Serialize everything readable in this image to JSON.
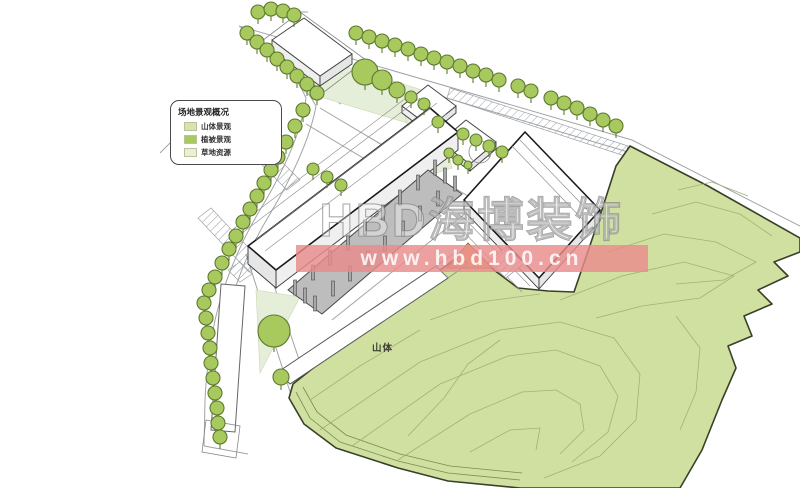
{
  "legend": {
    "title": "场地景观概况",
    "items": [
      {
        "label": "山体景观",
        "color": "#d8e4ae"
      },
      {
        "label": "植被景观",
        "color": "#a8c95e"
      },
      {
        "label": "草地资源",
        "color": "#e9efd9"
      }
    ]
  },
  "map_labels": {
    "mountain": "山体"
  },
  "watermark": {
    "brand": "HBD海博装饰",
    "url": "www.hbd100.cn"
  },
  "colors": {
    "background": "#ffffff",
    "mountain_fill": "#cfe0a0",
    "mountain_outline": "#384028",
    "contour_line": "#a3b178",
    "tree_fill": "#a8c95e",
    "tree_outline": "#5d7a30",
    "lawn_fill": "#e5eed8",
    "platform_fill": "#bdbdbd",
    "pillar_fill": "#a8a8a8",
    "building_fill": "#ffffff",
    "building_outline_bold": "#1a1a1a",
    "building_outline_light": "#888888",
    "road_line": "#a0a4a8",
    "slope_fill": "#e0a96b",
    "banner_fill": "#e98b8b",
    "banner_text": "#ffffff"
  },
  "diagram": {
    "trees": [
      [
        258,
        12,
        7
      ],
      [
        271,
        9,
        7
      ],
      [
        283,
        11,
        7
      ],
      [
        294,
        15,
        7
      ],
      [
        247,
        33,
        7
      ],
      [
        257,
        42,
        7
      ],
      [
        267,
        50,
        7
      ],
      [
        277,
        59,
        7
      ],
      [
        287,
        67,
        7
      ],
      [
        297,
        76,
        7
      ],
      [
        307,
        84,
        7
      ],
      [
        317,
        93,
        7
      ],
      [
        303,
        110,
        7
      ],
      [
        295,
        126,
        7
      ],
      [
        286,
        142,
        7
      ],
      [
        278,
        157,
        7
      ],
      [
        271,
        170,
        7
      ],
      [
        264,
        183,
        7
      ],
      [
        257,
        196,
        7
      ],
      [
        250,
        209,
        7
      ],
      [
        243,
        222,
        7
      ],
      [
        236,
        236,
        7
      ],
      [
        229,
        249,
        7
      ],
      [
        222,
        263,
        7
      ],
      [
        215,
        277,
        7
      ],
      [
        209,
        290,
        7
      ],
      [
        204,
        303,
        7
      ],
      [
        206,
        318,
        7
      ],
      [
        208,
        333,
        7
      ],
      [
        210,
        348,
        7
      ],
      [
        211,
        363,
        7
      ],
      [
        213,
        378,
        7
      ],
      [
        215,
        393,
        7
      ],
      [
        217,
        408,
        7
      ],
      [
        218,
        423,
        7
      ],
      [
        220,
        437,
        7
      ],
      [
        356,
        33,
        7
      ],
      [
        369,
        37,
        7
      ],
      [
        382,
        41,
        7
      ],
      [
        395,
        45,
        7
      ],
      [
        408,
        49,
        7
      ],
      [
        421,
        54,
        7
      ],
      [
        434,
        58,
        7
      ],
      [
        447,
        62,
        7
      ],
      [
        460,
        66,
        7
      ],
      [
        473,
        71,
        7
      ],
      [
        486,
        75,
        7
      ],
      [
        499,
        80,
        7
      ],
      [
        518,
        86,
        7
      ],
      [
        531,
        91,
        7
      ],
      [
        551,
        98,
        7
      ],
      [
        564,
        103,
        7
      ],
      [
        577,
        108,
        7
      ],
      [
        590,
        114,
        7
      ],
      [
        603,
        120,
        7
      ],
      [
        616,
        126,
        7
      ],
      [
        463,
        134,
        6
      ],
      [
        476,
        140,
        6
      ],
      [
        489,
        146,
        6
      ],
      [
        502,
        152,
        6
      ],
      [
        365,
        72,
        13
      ],
      [
        382,
        80,
        10
      ],
      [
        397,
        90,
        8
      ],
      [
        411,
        97,
        6
      ],
      [
        424,
        104,
        6
      ],
      [
        438,
        122,
        6
      ],
      [
        449,
        153,
        5
      ],
      [
        458,
        160,
        5
      ],
      [
        468,
        165,
        4
      ],
      [
        313,
        169,
        6
      ],
      [
        327,
        177,
        6
      ],
      [
        341,
        185,
        6
      ],
      [
        274,
        331,
        16
      ],
      [
        281,
        377,
        8
      ]
    ],
    "pillars": [
      [
        295,
        295
      ],
      [
        313,
        280
      ],
      [
        330,
        265
      ],
      [
        348,
        250
      ],
      [
        365,
        235
      ],
      [
        383,
        220
      ],
      [
        400,
        205
      ],
      [
        418,
        190
      ],
      [
        435,
        175
      ],
      [
        315,
        311
      ],
      [
        333,
        296
      ],
      [
        350,
        281
      ],
      [
        368,
        266
      ],
      [
        385,
        251
      ],
      [
        403,
        236
      ],
      [
        420,
        221
      ],
      [
        438,
        206
      ],
      [
        455,
        191
      ],
      [
        305,
        303
      ],
      [
        445,
        183
      ]
    ]
  }
}
